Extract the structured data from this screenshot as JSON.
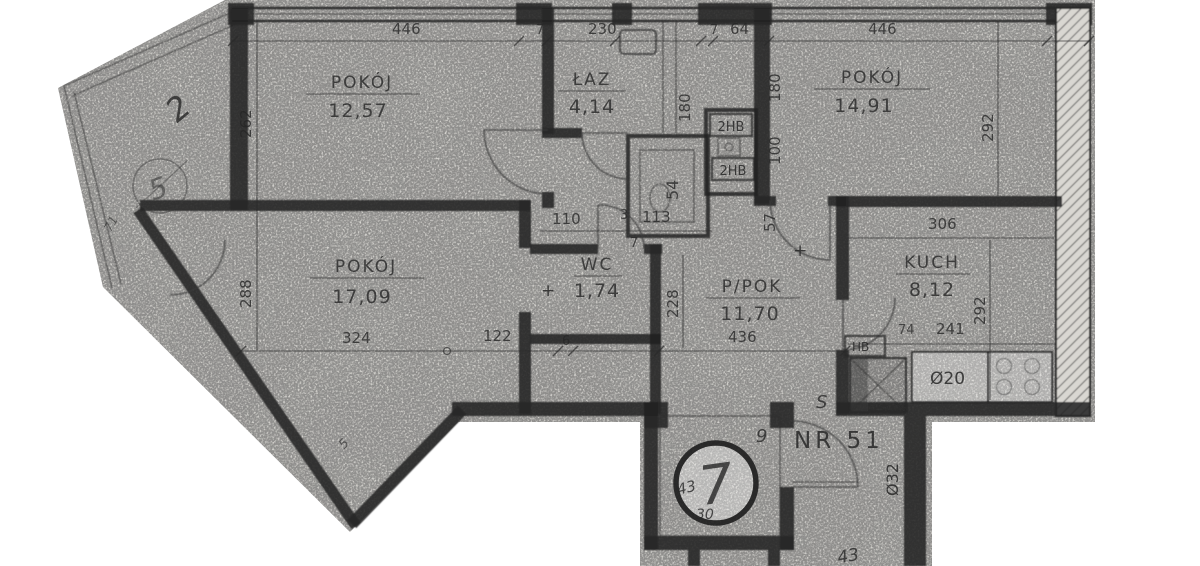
{
  "rooms": [
    {
      "name": "POKÓJ",
      "area": "12,57"
    },
    {
      "name": "ŁAZ",
      "area": "4,14"
    },
    {
      "name": "POKÓJ",
      "area": "14,91"
    },
    {
      "name": "POKÓJ",
      "area": "17,09"
    },
    {
      "name": "WC",
      "area": "1,74"
    },
    {
      "name": "P/POK",
      "area": "11,70"
    },
    {
      "name": "KUCH",
      "area": "8,12"
    }
  ],
  "dims": {
    "top": [
      "446",
      "7",
      "230",
      "7",
      "64",
      "446"
    ],
    "left": [
      "262",
      "288"
    ],
    "middle": [
      "110",
      "3",
      "113",
      "7"
    ],
    "risers": [
      "180",
      "180",
      "100",
      "57",
      "54"
    ],
    "bottom": [
      "324",
      "122",
      "6",
      "436",
      "228"
    ],
    "right": [
      "292",
      "306",
      "292"
    ],
    "kitchen": [
      "74",
      "241"
    ]
  },
  "annotations": {
    "apartment_no": "NR 51",
    "stamp_number": "7",
    "hand_43": "43",
    "hand_30": "30",
    "hand_9": "9",
    "hand_s": "S",
    "sink_label": "Ø20",
    "pipe_label": "Ø32",
    "hb_label": "HB",
    "shaft_label_1": "2HB",
    "shaft_label_2": "2HB",
    "balcony_hand_2": "2",
    "balcony_circle_5": "5",
    "balcony_71": "71",
    "diagonal_5": "5",
    "bottom_hand_43": "43",
    "level_mark_1": "+",
    "level_mark_2": "+"
  }
}
